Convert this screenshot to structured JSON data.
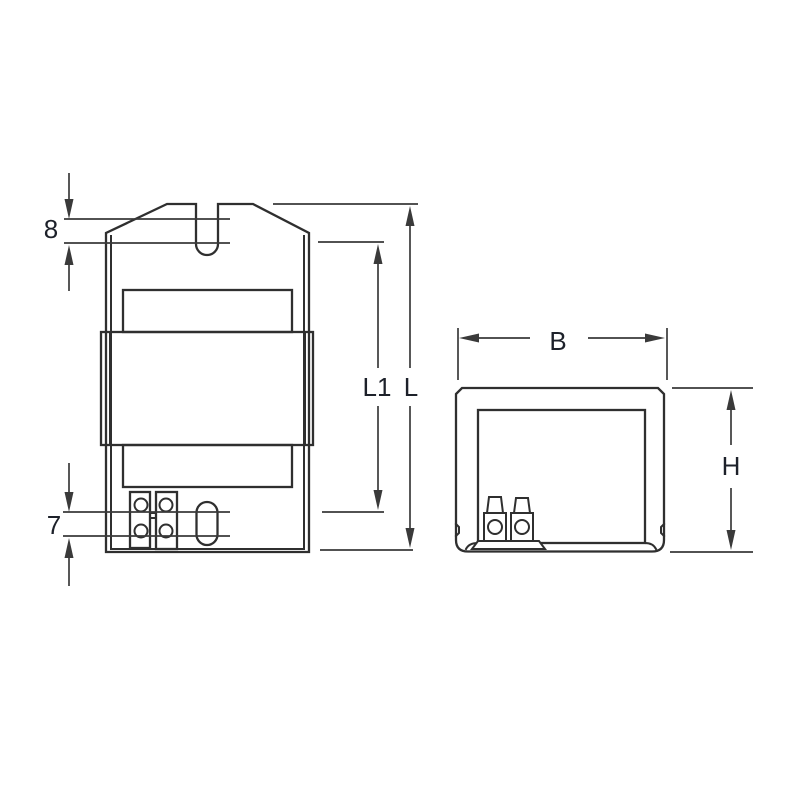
{
  "colors": {
    "line": "#2f2f2f",
    "dimension_line": "#3a3a3a",
    "label": "#1d212a",
    "background": "#ffffff"
  },
  "front_view": {
    "labels": {
      "slot_depth": "8",
      "terminal_offset": "7",
      "inner_length": "L1",
      "overall_length": "L"
    }
  },
  "side_view": {
    "labels": {
      "width": "B",
      "height": "H"
    }
  }
}
